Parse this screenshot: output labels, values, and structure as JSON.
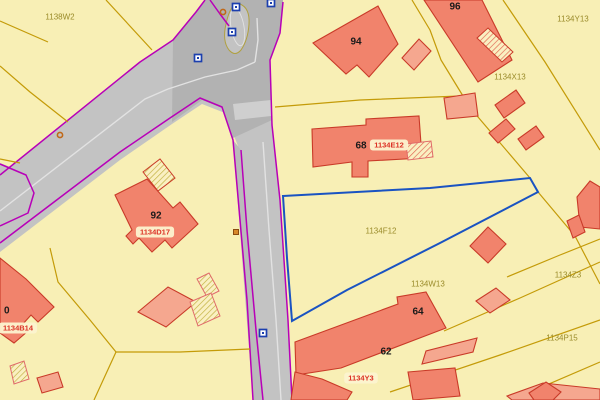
{
  "map": {
    "title": "cadastral-map-view",
    "colors": {
      "background": "#F8EFB5",
      "road": "#C3C3C3",
      "road_dark": "#B2B2B2",
      "road_parking": "#BABABA",
      "road_crossing": "#CFCFCF",
      "lane_white": "#E2E2E2",
      "magenta": "#B800B8",
      "parcel_line": "#C49B08",
      "parcel_text": "#9A8B2A",
      "building_fill": "#F1836C",
      "building_light": "#F5A78F",
      "building_stroke": "#C93A28",
      "hatch_bg": "#FAF0C2",
      "hatch_red": "#E0604E",
      "hatch_olive": "#BFAE3A",
      "hatch_pink_stroke": "#E06A6A",
      "highlight_blue": "#1A53C2",
      "label_red": "#DC3226",
      "label_pill_bg": "#FCF3D0",
      "number_black": "#1A1A1A",
      "marker_blue": "#1C3FAE",
      "marker_orange": "#C06818",
      "island_stroke": "#B0A040"
    },
    "road": {
      "outer": "205,0 196,12 173,40 140,62 0,175 0,252 120,160 172,124 202,104 225,113 238,146 244,222 251,300 258,400 292,400 288,320 280,200 272,125 270,60 280,33 283,0",
      "stub": "0,163 28,174 36,192 30,214 0,228",
      "intersection_patch": "173,40 205,0 283,0 280,33 270,60 272,120 233,138 222,108 202,100 172,122",
      "parking_strip": "233,140 241,150 263,400 253,400",
      "crossing_band": "233,104 271,100 271,116 235,120",
      "island": "M 240,4 Q 250,8 249,24 Q 248,40 241,50 Q 235,57 229,50 Q 222,41 226,24 Q 229,10 234,5 Z",
      "island_inner": {
        "cx": 237.5,
        "cy": 27,
        "rx": 6.5,
        "ry": 19,
        "rot": -10
      },
      "magenta_lines": [
        "205,0 196,12 173,40 140,62 0,175",
        "0,243 120,152 170,118 200,98 222,107 233,140 240,220 247,300 253,400",
        "283,2 280,33 270,60 272,125 280,200 288,320 292,400",
        "241,150 247,230 256,330 263,400",
        "0,164 26,175 34,193 28,213 0,226",
        "210,0 220,14 229,26"
      ],
      "white_lines": [
        "0,211 145,99 168,89",
        "168,89 205,77 237,70 255,62",
        "263,142 269,230 276,320 281,400",
        "255,62 258,40 257,18"
      ]
    },
    "parcel_lines": [
      "106,0 152,50",
      "0,21 48,42",
      "0,66 30,92 68,122",
      "0,159 20,163",
      "275,107 360,100 460,96",
      "412,0 430,30 441,60 463,96 478,117 530,178 538,192 575,236 600,284",
      "503,0 545,62 600,150",
      "444,331 520,298 600,262",
      "390,392 500,355 600,320",
      "521,396 600,362",
      "507,277 560,255 600,239",
      "50,248 58,282 90,320 116,352",
      "116,352 180,352 250,349",
      "116,352 94,400"
    ],
    "highlight_parcel": {
      "points": "283,196 430,188 530,178 538,192 440,243 347,290 292,321 287,258"
    },
    "buildings": [
      {
        "id": "building-96",
        "fill": "main",
        "points": "424,0 482,0 512,60 478,82"
      },
      {
        "id": "building-94",
        "fill": "main",
        "points": "313,43 378,6 398,44 369,77 357,65 346,74"
      },
      {
        "id": "building-94-annex",
        "fill": "light",
        "points": "402,58 419,39 431,51 414,70"
      },
      {
        "id": "building-68",
        "fill": "main",
        "points": "312,129 366,125 366,119 419,116 422,158 368,161 368,177 352,177 352,162 313,167"
      },
      {
        "id": "building-68-neighbor",
        "fill": "light",
        "points": "444,98 475,93 478,116 447,119"
      },
      {
        "id": "building-x13-a",
        "fill": "main",
        "points": "516,90 525,103 504,118 495,105"
      },
      {
        "id": "building-x13-b",
        "fill": "main",
        "points": "506,119 515,129 498,143 489,133"
      },
      {
        "id": "building-x13-c",
        "fill": "main",
        "points": "536,126 544,137 526,150 518,139"
      },
      {
        "id": "building-92",
        "fill": "main",
        "points": "115,195 147,179 173,208 180,202 198,224 172,248 165,240 152,252 139,238 133,244 126,236 132,230"
      },
      {
        "id": "building-right-big",
        "fill": "main",
        "points": "577,197 590,181 600,187 600,229 580,227"
      },
      {
        "id": "building-right-small",
        "fill": "main",
        "points": "567,221 579,215 585,232 573,238"
      },
      {
        "id": "building-w13",
        "fill": "main",
        "points": "470,246 488,227 506,244 488,263"
      },
      {
        "id": "building-w13-shed",
        "fill": "light",
        "points": "476,301 496,288 510,300 490,313"
      },
      {
        "id": "building-64-62",
        "fill": "main",
        "points": "295,342 398,304 397,297 426,292 446,328 341,368 296,375"
      },
      {
        "id": "building-62-wing",
        "fill": "main",
        "points": "295,372 322,379 352,392 347,400 291,400"
      },
      {
        "id": "building-bottom",
        "fill": "main",
        "points": "408,372 455,368 460,396 413,400"
      },
      {
        "id": "building-bottom-light",
        "fill": "light",
        "points": "422,364 426,351 477,338 473,352"
      },
      {
        "id": "building-bottom-right-light",
        "fill": "light",
        "points": "507,396 543,383 600,389 600,400 512,400"
      },
      {
        "id": "building-bottom-right",
        "fill": "main",
        "points": "529,393 546,382 561,392 553,400 534,400"
      },
      {
        "id": "building-b14",
        "fill": "main",
        "points": "0,258 26,279 54,307 38,322 31,315 22,325 28,331 14,343 0,333"
      },
      {
        "id": "building-b14-light",
        "fill": "light",
        "points": "138,312 168,287 196,302 166,327"
      },
      {
        "id": "building-b14-shed",
        "fill": "light",
        "points": "37,378 58,372 63,387 42,393"
      }
    ],
    "hatched_buildings": [
      {
        "id": "annex-96",
        "hatch": "red",
        "stroke": "red",
        "points": "488,28 513,52 502,62 477,38"
      },
      {
        "id": "annex-68",
        "hatch": "red",
        "stroke": "pink",
        "points": "406,144 431,141 433,157 408,160"
      },
      {
        "id": "annex-92",
        "hatch": "olive",
        "stroke": "red",
        "points": "143,172 160,159 175,178 158,191"
      },
      {
        "id": "annex-bl-1",
        "hatch": "olive",
        "stroke": "pink",
        "points": "197,279 209,273 219,291 207,297"
      },
      {
        "id": "annex-bl-2",
        "hatch": "olive",
        "stroke": "pink",
        "points": "190,302 211,293 220,316 198,326"
      },
      {
        "id": "annex-bl-3",
        "hatch": "olive",
        "stroke": "pink",
        "points": "10,366 24,361 29,379 14,384"
      }
    ],
    "house_numbers": [
      {
        "text": "94",
        "x": 356,
        "y": 42
      },
      {
        "text": "96",
        "x": 455,
        "y": 7
      },
      {
        "text": "68",
        "x": 361,
        "y": 146
      },
      {
        "text": "92",
        "x": 156,
        "y": 216
      },
      {
        "text": "64",
        "x": 418,
        "y": 312
      },
      {
        "text": "62",
        "x": 386,
        "y": 352
      },
      {
        "text": "0",
        "x": 4,
        "y": 311
      }
    ],
    "parcel_ids": [
      {
        "text": "1138W2",
        "x": 60,
        "y": 17
      },
      {
        "text": "1134Y13",
        "x": 573,
        "y": 19
      },
      {
        "text": "1134X13",
        "x": 510,
        "y": 77
      },
      {
        "text": "1134F12",
        "x": 381,
        "y": 231
      },
      {
        "text": "1134W13",
        "x": 428,
        "y": 284
      },
      {
        "text": "1134Z3",
        "x": 568,
        "y": 275
      },
      {
        "text": "1134P15",
        "x": 562,
        "y": 338
      }
    ],
    "highlighted_labels": [
      {
        "text": "1134E12",
        "x": 389,
        "y": 145
      },
      {
        "text": "1134D17",
        "x": 155,
        "y": 232
      },
      {
        "text": "1134Y3",
        "x": 361,
        "y": 378
      },
      {
        "text": "1134B14",
        "x": 18,
        "y": 328
      }
    ],
    "markers": {
      "blue_squares": [
        [
          236,
          7
        ],
        [
          271,
          3
        ],
        [
          232,
          32
        ],
        [
          198,
          58
        ],
        [
          263,
          333
        ]
      ],
      "orange_circles": [
        [
          223,
          12
        ],
        [
          60,
          135
        ]
      ],
      "orange_squares": [
        [
          236,
          232
        ]
      ]
    }
  }
}
